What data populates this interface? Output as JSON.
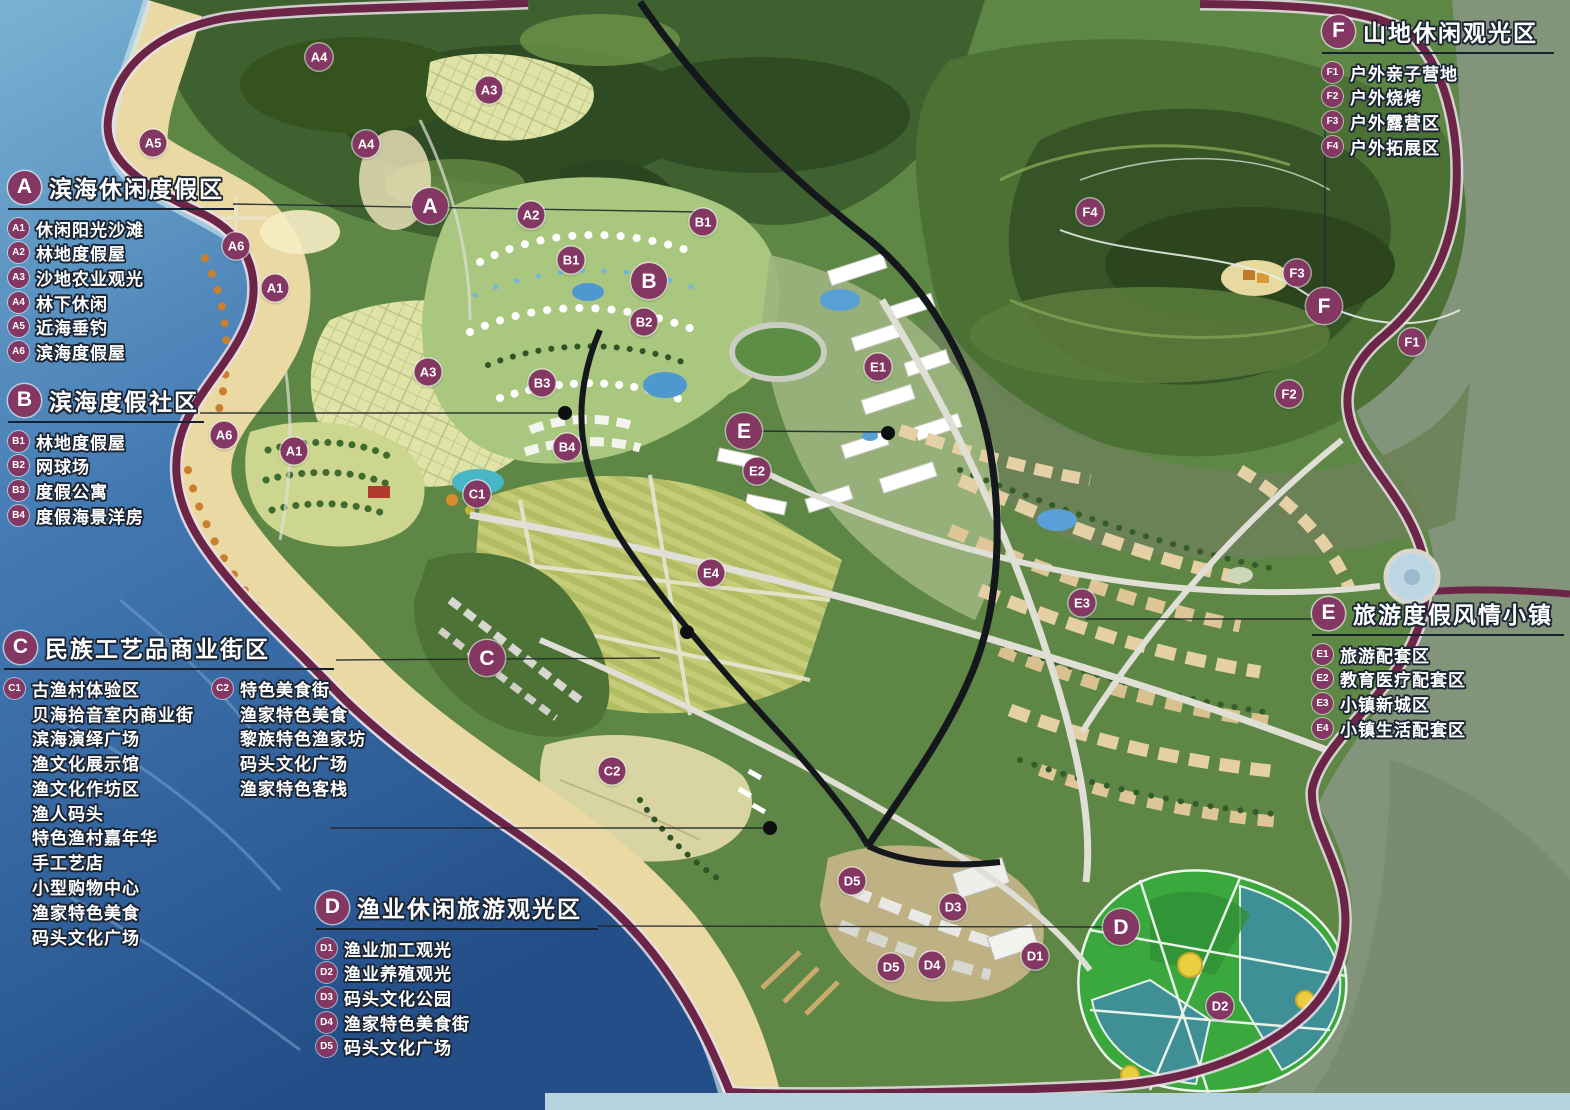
{
  "title": "旅游区总体规划图",
  "colors": {
    "marker_bg": "#843763",
    "text_outline": "#1b2533",
    "boundary_road": "#6d2547",
    "sea_deep": "#27588f",
    "sea_light": "#79b3d3",
    "beach_sand": "#ead9a3",
    "forest_dark": "#3f6130",
    "pond_green": "#3aa83c",
    "pond_teal": "#3f8f97"
  },
  "legends": [
    {
      "id": "A",
      "title": "滨海休闲度假区",
      "x": 8,
      "y": 170,
      "rule_w": 226,
      "items": [
        {
          "code": "A1",
          "label": "休闲阳光沙滩"
        },
        {
          "code": "A2",
          "label": "林地度假屋"
        },
        {
          "code": "A3",
          "label": "沙地农业观光"
        },
        {
          "code": "A4",
          "label": "林下休闲"
        },
        {
          "code": "A5",
          "label": "近海垂钓"
        },
        {
          "code": "A6",
          "label": "滨海度假屋"
        }
      ]
    },
    {
      "id": "B",
      "title": "滨海度假社区",
      "x": 8,
      "y": 383,
      "rule_w": 196,
      "items": [
        {
          "code": "B1",
          "label": "林地度假屋"
        },
        {
          "code": "B2",
          "label": "网球场"
        },
        {
          "code": "B3",
          "label": "度假公寓"
        },
        {
          "code": "B4",
          "label": "度假海景洋房"
        }
      ]
    },
    {
      "id": "C",
      "title": "民族工艺品商业街区",
      "x": 4,
      "y": 630,
      "rule_w": 330,
      "columns": [
        {
          "head": {
            "code": "C1",
            "label": "古渔村体验区"
          },
          "lines": [
            "贝海拾音室内商业街",
            "滨海演绎广场",
            "渔文化展示馆",
            "渔文化作坊区",
            "渔人码头",
            "特色渔村嘉年华",
            "手工艺店",
            "小型购物中心",
            "渔家特色美食",
            "码头文化广场"
          ]
        },
        {
          "head": {
            "code": "C2",
            "label": "特色美食街"
          },
          "lines": [
            "渔家特色美食",
            "黎族特色渔家坊",
            "码头文化广场",
            "渔家特色客栈"
          ]
        }
      ]
    },
    {
      "id": "D",
      "title": "渔业休闲旅游观光区",
      "x": 316,
      "y": 890,
      "rule_w": 282,
      "items": [
        {
          "code": "D1",
          "label": "渔业加工观光"
        },
        {
          "code": "D2",
          "label": "渔业养殖观光"
        },
        {
          "code": "D3",
          "label": "码头文化公园"
        },
        {
          "code": "D4",
          "label": "渔家特色美食街"
        },
        {
          "code": "D5",
          "label": "码头文化广场"
        }
      ]
    },
    {
      "id": "E",
      "title": "旅游度假风情小镇",
      "x": 1312,
      "y": 596,
      "rule_w": 252,
      "items": [
        {
          "code": "E1",
          "label": "旅游配套区"
        },
        {
          "code": "E2",
          "label": "教育医疗配套区"
        },
        {
          "code": "E3",
          "label": "小镇新城区"
        },
        {
          "code": "E4",
          "label": "小镇生活配套区"
        }
      ]
    },
    {
      "id": "F",
      "title": "山地休闲观光区",
      "x": 1322,
      "y": 14,
      "rule_w": 232,
      "items": [
        {
          "code": "F1",
          "label": "户外亲子营地"
        },
        {
          "code": "F2",
          "label": "户外烧烤"
        },
        {
          "code": "F3",
          "label": "户外露营区"
        },
        {
          "code": "F4",
          "label": "户外拓展区"
        }
      ]
    }
  ],
  "map": {
    "markers": [
      {
        "code": "A",
        "x": 430,
        "y": 206,
        "major": true
      },
      {
        "code": "B",
        "x": 649,
        "y": 281,
        "major": true
      },
      {
        "code": "C",
        "x": 487,
        "y": 658,
        "major": true
      },
      {
        "code": "D",
        "x": 1121,
        "y": 927,
        "major": true
      },
      {
        "code": "E",
        "x": 744,
        "y": 431,
        "major": true
      },
      {
        "code": "F",
        "x": 1324,
        "y": 306,
        "major": true
      },
      {
        "code": "A1",
        "x": 275,
        "y": 288
      },
      {
        "code": "A1",
        "x": 294,
        "y": 451
      },
      {
        "code": "A2",
        "x": 531,
        "y": 215
      },
      {
        "code": "A3",
        "x": 489,
        "y": 90
      },
      {
        "code": "A3",
        "x": 428,
        "y": 372
      },
      {
        "code": "A4",
        "x": 319,
        "y": 57
      },
      {
        "code": "A4",
        "x": 366,
        "y": 144
      },
      {
        "code": "A5",
        "x": 153,
        "y": 143
      },
      {
        "code": "A6",
        "x": 236,
        "y": 246
      },
      {
        "code": "A6",
        "x": 224,
        "y": 435
      },
      {
        "code": "B1",
        "x": 703,
        "y": 222
      },
      {
        "code": "B1",
        "x": 571,
        "y": 260
      },
      {
        "code": "B2",
        "x": 644,
        "y": 322
      },
      {
        "code": "B3",
        "x": 542,
        "y": 383
      },
      {
        "code": "B4",
        "x": 567,
        "y": 447
      },
      {
        "code": "C1",
        "x": 477,
        "y": 494
      },
      {
        "code": "C2",
        "x": 612,
        "y": 771
      },
      {
        "code": "D1",
        "x": 1035,
        "y": 956
      },
      {
        "code": "D2",
        "x": 1220,
        "y": 1006
      },
      {
        "code": "D3",
        "x": 953,
        "y": 907
      },
      {
        "code": "D4",
        "x": 932,
        "y": 965
      },
      {
        "code": "D5",
        "x": 852,
        "y": 881
      },
      {
        "code": "D5",
        "x": 891,
        "y": 967
      },
      {
        "code": "E1",
        "x": 878,
        "y": 367
      },
      {
        "code": "E2",
        "x": 757,
        "y": 471
      },
      {
        "code": "E3",
        "x": 1082,
        "y": 603
      },
      {
        "code": "E4",
        "x": 711,
        "y": 573
      },
      {
        "code": "F1",
        "x": 1412,
        "y": 342
      },
      {
        "code": "F2",
        "x": 1289,
        "y": 394
      },
      {
        "code": "F3",
        "x": 1297,
        "y": 273
      },
      {
        "code": "F4",
        "x": 1090,
        "y": 212
      }
    ]
  }
}
